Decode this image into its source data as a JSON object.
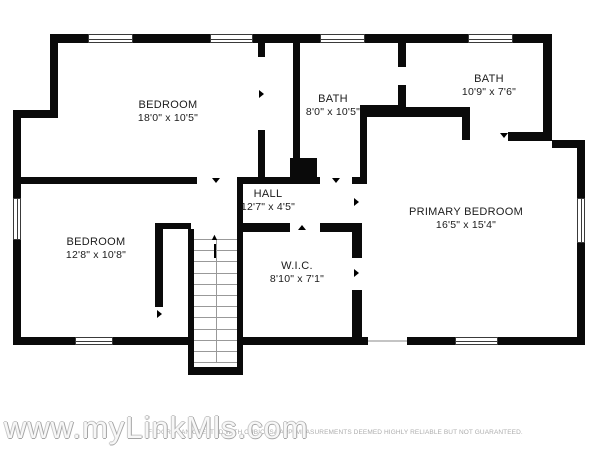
{
  "plan": {
    "rooms": [
      {
        "name": "BEDROOM",
        "dims": "18'0\" x 10'5\""
      },
      {
        "name": "BATH",
        "dims": "8'0\" x 10'5\""
      },
      {
        "name": "BATH",
        "dims": "10'9\" x 7'6\""
      },
      {
        "name": "HALL",
        "dims": "12'7\" x 4'5\""
      },
      {
        "name": "BEDROOM",
        "dims": "12'8\" x 10'8\""
      },
      {
        "name": "W.I.C.",
        "dims": "8'10\" x 7'1\""
      },
      {
        "name": "PRIMARY BEDROOM",
        "dims": "16'5\" x 15'4\""
      }
    ]
  },
  "icons": {
    "stairs_up_arrow": "▲"
  },
  "footer": {
    "watermark": "www.myLinkMls.com",
    "disclaimer": "FLOOR PLAN CREATED WITH CUBICASA APP. MEASUREMENTS DEEMED HIGHLY RELIABLE BUT NOT GUARANTEED."
  },
  "colors": {
    "wall": "#0a0a0a",
    "background": "#ffffff",
    "label_text": "#1b1b1b",
    "watermark_outline": "#a3a3a3",
    "disclaimer_text": "#adadad"
  }
}
